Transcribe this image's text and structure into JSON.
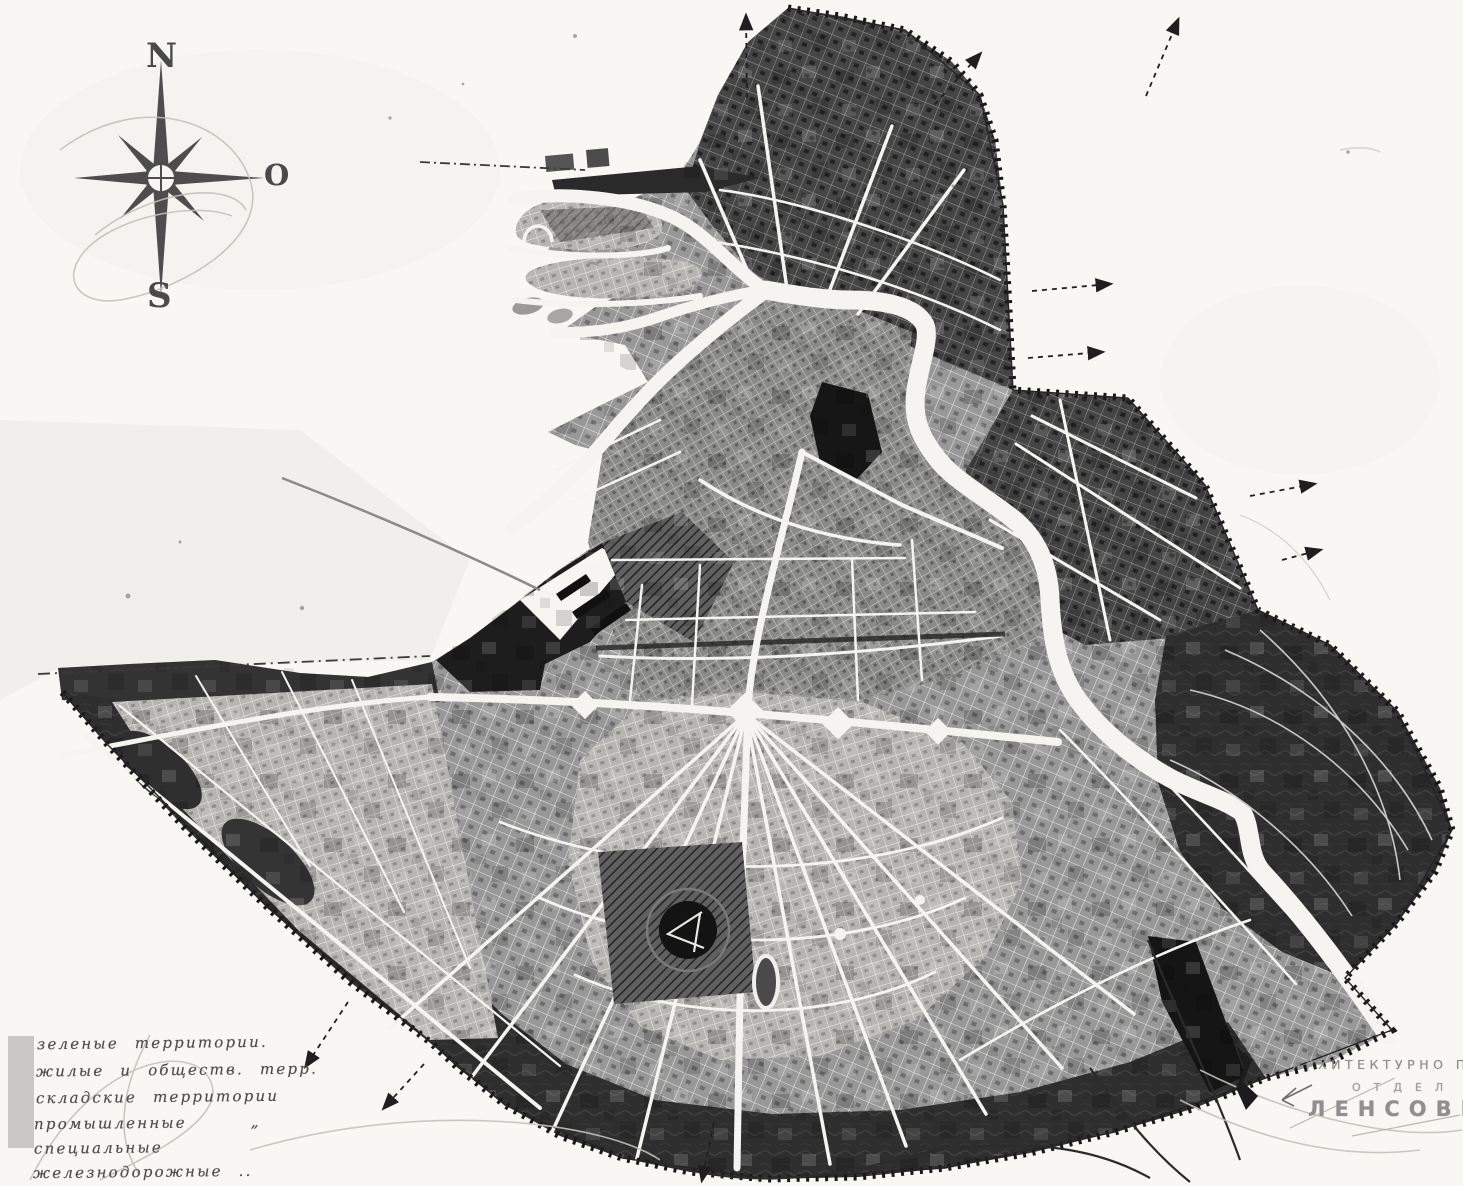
{
  "palette": {
    "paper": "#f8f7f4",
    "ink": "#1f1f1f",
    "river": "#f5f4f1",
    "dark": "#2e2e2e",
    "pencil": "#c5c1ba",
    "legend-text": "#4e4e4e",
    "attr-text": "#8e8e8e",
    "swatch": "#c9c8c4"
  },
  "compass": {
    "north": "N",
    "east": "O",
    "south": "S"
  },
  "legend": {
    "items": [
      "зеленые территории.",
      "жилые и обществ. терр.",
      "складские территории",
      "промышленные    „",
      "специальные",
      "железнодорожные .."
    ]
  },
  "attribution": {
    "line1": "АРХИТЕКТУРНО ПЛАНИРОВО",
    "line2": "ОТДЕЛ",
    "line3": "ЛЕНСОВЕТА"
  }
}
